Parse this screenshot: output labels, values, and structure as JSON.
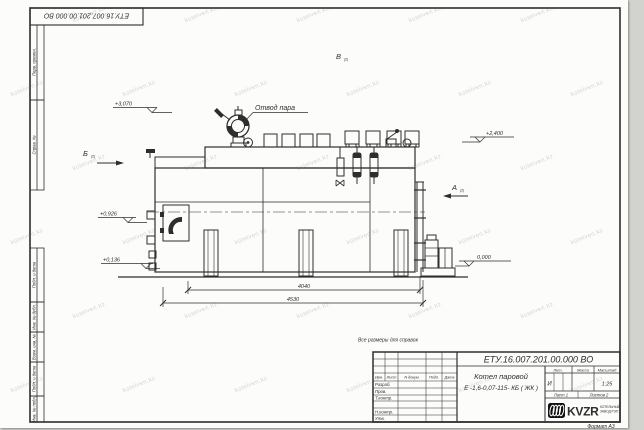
{
  "sheet": {
    "doc_number": "ЕТУ.16.007.201.00.000  ВО",
    "format_note": "Формат А3",
    "reference_note": "Все размеры для справок"
  },
  "margin_columns": {
    "perv_primen": "Перв. примен.",
    "sprav_no": "Справ. №",
    "podp_data_1": "Подп. и дата",
    "inv_dubl": "Инв. № дубл.",
    "vzam_inv": "Взам. инв. №",
    "podp_data_2": "Подп. и дата",
    "inv_podl": "Инв. № подл."
  },
  "title_block": {
    "doc_number": "ЕТУ.16.007.201.00.000  ВО",
    "product_name_line1": "Котел паровой",
    "product_name_line2": "Е -1,6-0,07-115- КБ ( ЖК )",
    "header_cols": [
      "Изм.",
      "Лист",
      "N докум.",
      "Подп.",
      "Дата"
    ],
    "sign_rows": [
      "Разраб.",
      "Пров.",
      "Т.контр.",
      "Н.контр.",
      "Утв."
    ],
    "lit_header": "Лит.",
    "mass_header": "Масса",
    "scale_header": "Масштаб",
    "lit_value": "И",
    "scale_value": "1:25",
    "sheet_info": "Лист 1",
    "sheets_info": "Листов 2",
    "company_logo_text": "KVZR",
    "company_name_line1": "КОТЕЛЬНЫЙ",
    "company_name_line2": "ЗАВОД РЭП"
  },
  "drawing": {
    "steam_outlet_label": "Отвод пара",
    "views": {
      "a": "А",
      "b": "Б",
      "v": "В",
      "sheet_ref": "(2)"
    },
    "elevations": {
      "top": "+3,070",
      "drum": "+2,400",
      "burner": "+0,926",
      "low": "+0,136",
      "ground": "0,000"
    },
    "dimensions": {
      "inner": "4040",
      "overall": "4530"
    }
  },
  "watermark": {
    "text": "kotelven.kz"
  },
  "colors": {
    "line": "#2e2e2e",
    "sheet": "#fcfcfa",
    "background": "#d2d2ce"
  }
}
